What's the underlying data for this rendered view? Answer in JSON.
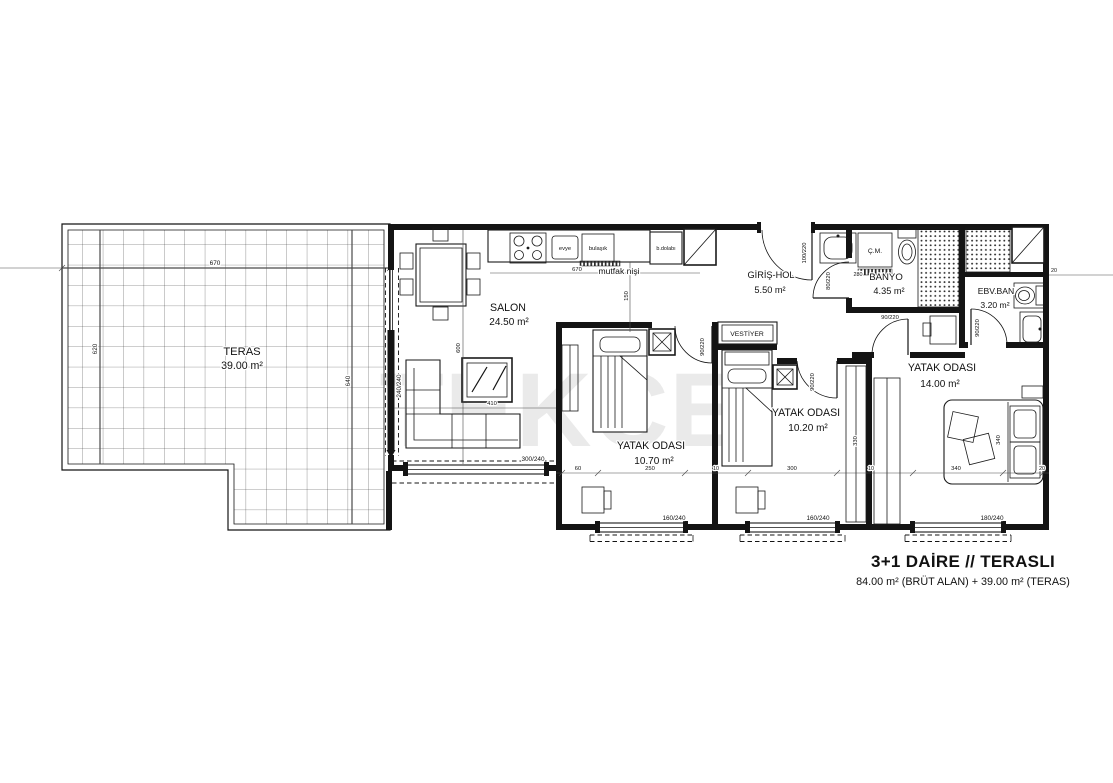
{
  "plan": {
    "watermark": "TEKCE",
    "title": "3+1 DAİRE // TERASLI",
    "subtitle": "84.00 m² (BRÜT ALAN) + 39.00 m² (TERAS)"
  },
  "rooms": {
    "teras": {
      "name": "TERAS",
      "area": "39.00 m²"
    },
    "salon": {
      "name": "SALON",
      "area": "24.50 m²"
    },
    "hol": {
      "name": "GİRİŞ-HOL",
      "area": "5.50 m²"
    },
    "banyo": {
      "name": "BANYO",
      "area": "4.35 m²"
    },
    "ebv": {
      "name": "EBV.BAN",
      "area": "3.20 m²"
    },
    "yatak1": {
      "name": "YATAK ODASI",
      "area": "10.70 m²"
    },
    "yatak2": {
      "name": "YATAK ODASI",
      "area": "10.20 m²"
    },
    "yatak3": {
      "name": "YATAK ODASI",
      "area": "14.00 m²"
    },
    "vestiyer": {
      "name": "VESTİYER"
    }
  },
  "kitchen": {
    "niche": "mutfak nişi",
    "evye": "evye",
    "bulasik": "bulaşık",
    "bdolabi": "b.dolabı"
  },
  "fixtures": {
    "cm": "Ç.M."
  },
  "dims": {
    "teras_w": "670",
    "teras_hl": "620",
    "teras_hr": "640",
    "kitchen_w": "670",
    "niche_d": "150",
    "salon_h": "600",
    "salon_w": "410",
    "salon_win": "300/240",
    "teras_door": "240/240",
    "entry_door": "100/220",
    "banyo_door": "80/220",
    "room_door": "90/220",
    "win_small": "160/240",
    "win_big": "180/240",
    "banyo_w": "280",
    "bed2_d": "330",
    "bed3_d": "340",
    "seg_60": "60",
    "seg_250": "250",
    "seg_10": "10",
    "seg_300": "300",
    "seg_340": "340",
    "seg_20": "20"
  }
}
